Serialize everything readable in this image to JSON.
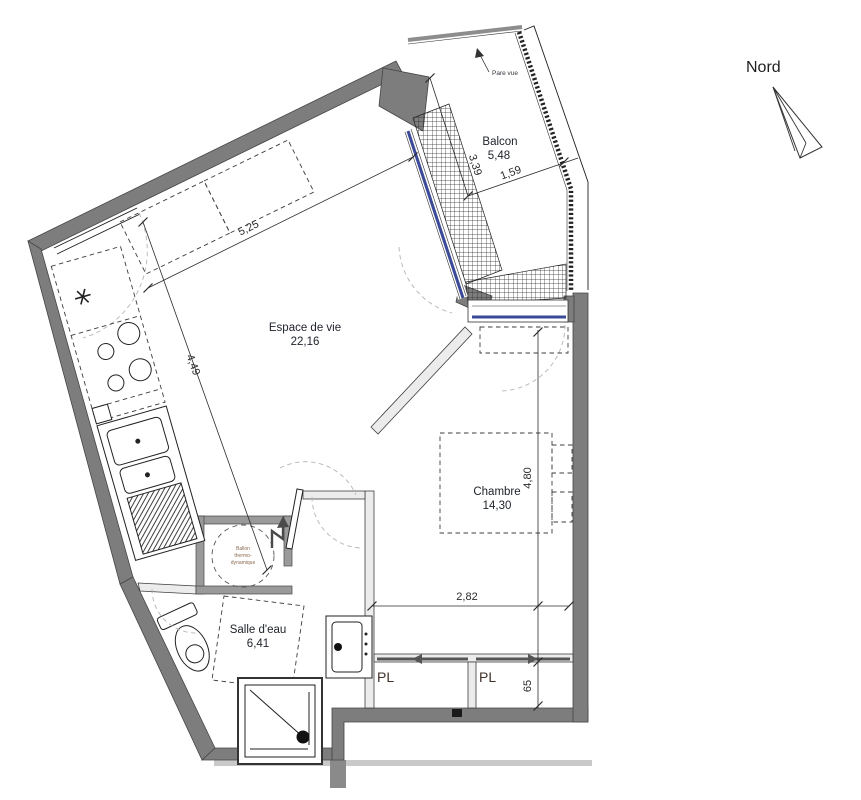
{
  "compass": {
    "label": "Nord"
  },
  "rooms": {
    "living": {
      "name": "Espace de vie",
      "area": "22,16"
    },
    "bedroom": {
      "name": "Chambre",
      "area": "14,30"
    },
    "bathroom": {
      "name": "Salle d'eau",
      "area": "6,41"
    },
    "balcony": {
      "name": "Balcon",
      "area": "5,48"
    },
    "closet1": {
      "name": "PL"
    },
    "closet2": {
      "name": "PL"
    }
  },
  "annotations": {
    "pare_vue": "Pare vue",
    "water_heater": {
      "line1": "Ballon",
      "line2": "thermo-",
      "line3": "dynamique"
    }
  },
  "dimensions": {
    "living_width": "5,25",
    "living_depth": "4,49",
    "balcony_depth": "3,39",
    "balcony_width": "1,59",
    "bedroom_width": "2,82",
    "bedroom_depth": "4,80",
    "closet_depth": "65"
  },
  "colors": {
    "wall": "#7d7d7d",
    "partition": "#ececec",
    "window_blue": "#3b4a97",
    "dashed_furniture": "#3c3c3c",
    "swing_arc": "#b5b5b5",
    "room_text": "#20242c",
    "dimension_text": "#2b2b2b",
    "closet_text": "#42322a",
    "heater_text": "#8a6a50"
  }
}
